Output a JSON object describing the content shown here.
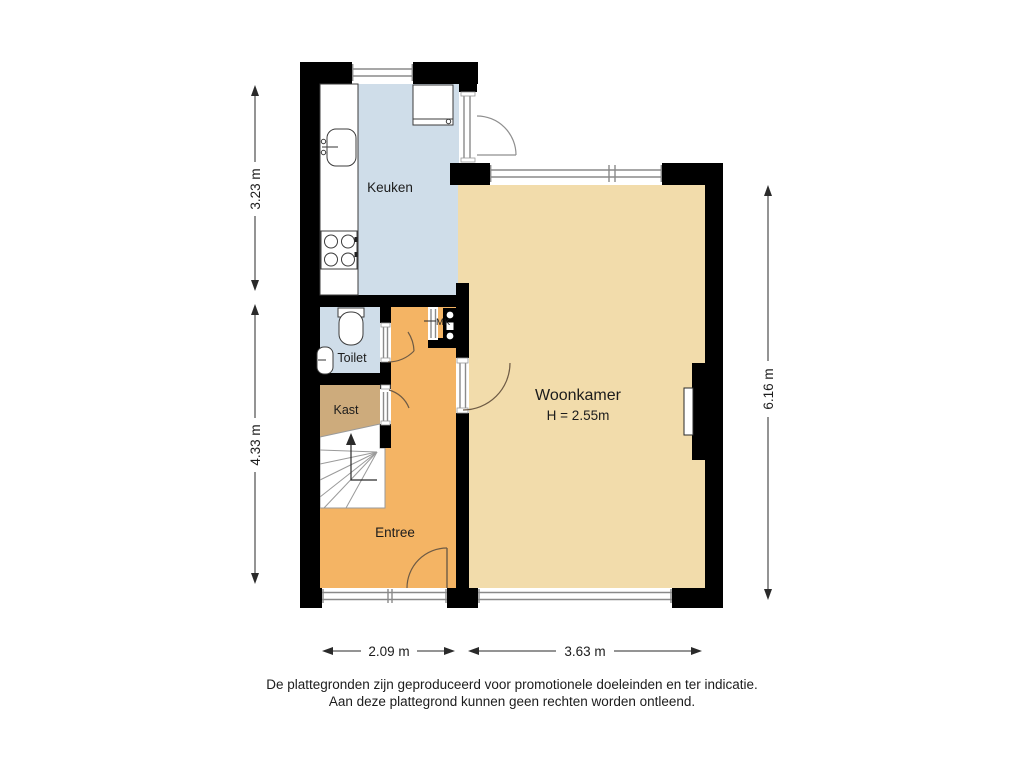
{
  "plan": {
    "rooms": {
      "keuken": {
        "label": "Keuken"
      },
      "woonkamer": {
        "label": "Woonkamer",
        "height_note": "H = 2.55m"
      },
      "toilet": {
        "label": "Toilet"
      },
      "kast": {
        "label": "Kast"
      },
      "entree": {
        "label": "Entree"
      },
      "meterkast": {
        "label": "MK"
      }
    },
    "dimensions": {
      "kitchen_depth": "3.23 m",
      "hall_depth": "4.33 m",
      "living_depth": "6.16 m",
      "hall_width": "2.09 m",
      "living_width": "3.63 m"
    },
    "disclaimer": {
      "line1": "De plattegronden zijn geproduceerd voor promotionele doeleinden en ter indicatie.",
      "line2": "Aan deze plattegrond kunnen geen rechten worden ontleend."
    },
    "colors": {
      "wall": "#000000",
      "kitchen_floor": "#cfdde9",
      "toilet_floor": "#cfdde9",
      "living_floor": "#f2dcab",
      "hall_floor": "#f4b464",
      "closet_floor": "#cdab7c",
      "background": "#ffffff"
    }
  }
}
